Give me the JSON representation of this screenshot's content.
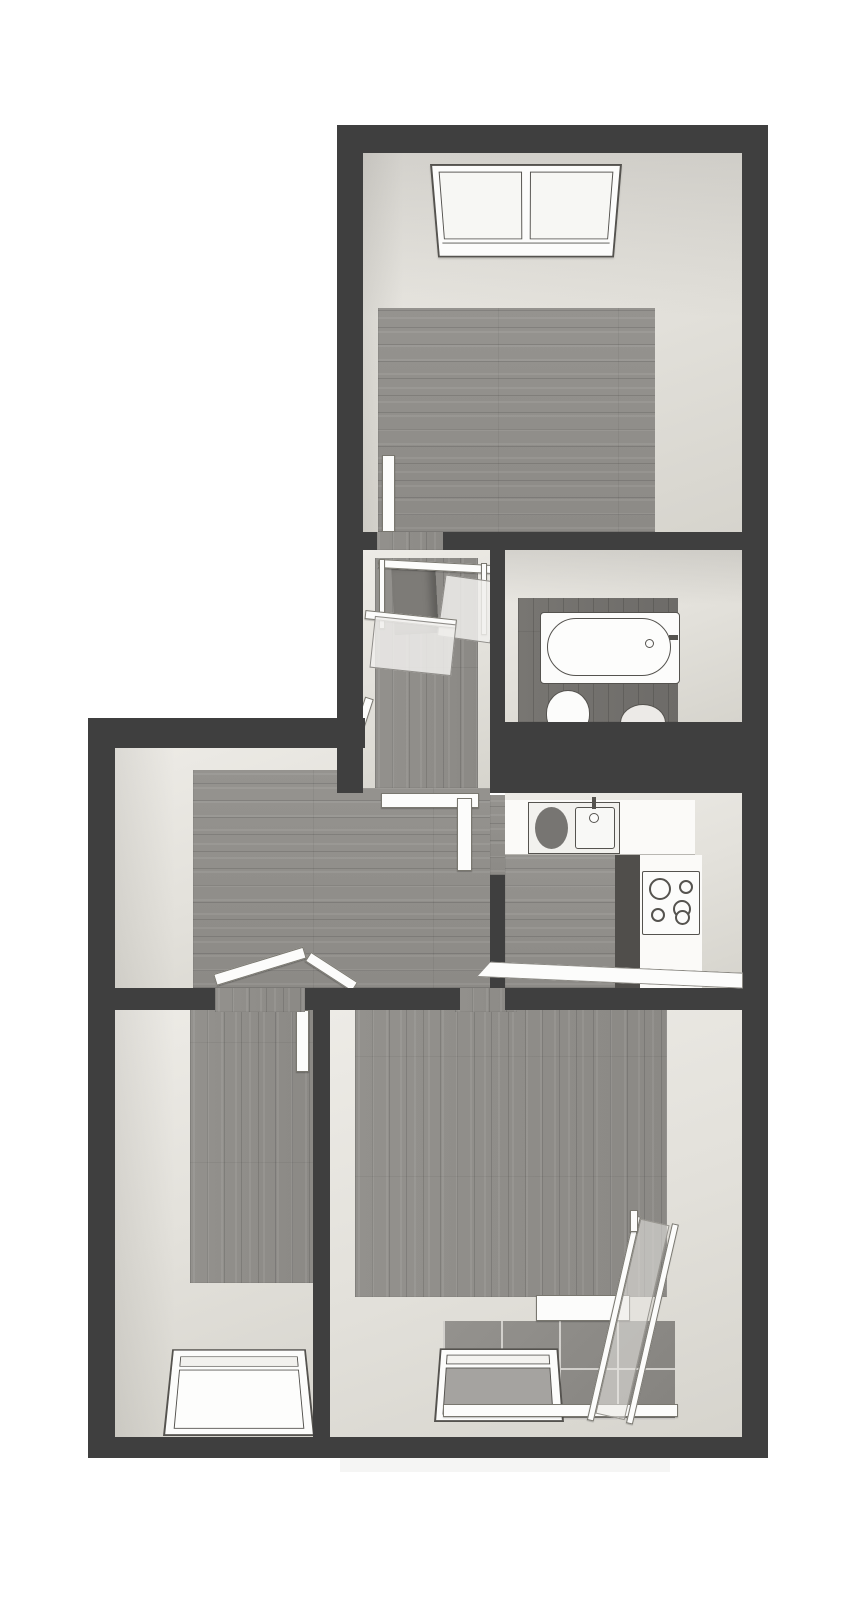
{
  "canvas": {
    "width": 867,
    "height": 1600,
    "kind": "3d-top-view-floor-plan"
  },
  "palette": {
    "background": "#ffffff",
    "wall_dark": "#3f3f3f",
    "wall_light": "#e3e1db",
    "floor_wood": "#918f8b",
    "floor_wood_dark": "#757370",
    "balcony_tile": "#8f8d89",
    "fixture_white": "#fcfcfb",
    "fixture_outline": "#55534f",
    "glass": "#f0efec"
  },
  "rooms": [
    {
      "id": "bedroom-top",
      "name": "Top room with skylight window",
      "features": [
        "skylight-window",
        "wood-floor",
        "door-opening"
      ]
    },
    {
      "id": "stair-landing",
      "name": "Stair landing with railing",
      "features": [
        "stair-opening",
        "railing",
        "glass-panels"
      ]
    },
    {
      "id": "bathroom",
      "name": "Bathroom",
      "features": [
        "bathtub",
        "toilet",
        "bidet",
        "dark-wood-floor"
      ]
    },
    {
      "id": "hallway",
      "name": "Hallway",
      "features": [
        "door-openings",
        "wood-floor"
      ]
    },
    {
      "id": "kitchen",
      "name": "Kitchen",
      "features": [
        "sink-unit",
        "cooktop",
        "counter"
      ]
    },
    {
      "id": "room-bottom-left",
      "name": "Bottom-left room with skylight window",
      "features": [
        "skylight-window",
        "door-leaf",
        "wood-floor"
      ]
    },
    {
      "id": "living-room",
      "name": "Living room",
      "features": [
        "window",
        "balcony",
        "wood-floor"
      ]
    },
    {
      "id": "balcony",
      "name": "Balcony with glass railing",
      "features": [
        "tiled-floor",
        "glass-railing",
        "window-door"
      ]
    }
  ],
  "fixtures": [
    {
      "id": "skylight-top",
      "name": "double-pane skylight window"
    },
    {
      "id": "bathtub",
      "name": "bathtub with inner rim and tap"
    },
    {
      "id": "toilet",
      "name": "toilet (partially hidden by wall)"
    },
    {
      "id": "bidet",
      "name": "bidet (partially hidden by wall)"
    },
    {
      "id": "kitchen-sink",
      "name": "sink unit with drainer and basin"
    },
    {
      "id": "cooktop",
      "name": "4-burner cooktop"
    },
    {
      "id": "stair-opening",
      "name": "staircase opening going down"
    },
    {
      "id": "skylight-bottom-left",
      "name": "skylight window in sloped roof"
    },
    {
      "id": "living-window",
      "name": "roof window above balcony"
    },
    {
      "id": "glass-railing",
      "name": "balcony glass railing"
    }
  ]
}
